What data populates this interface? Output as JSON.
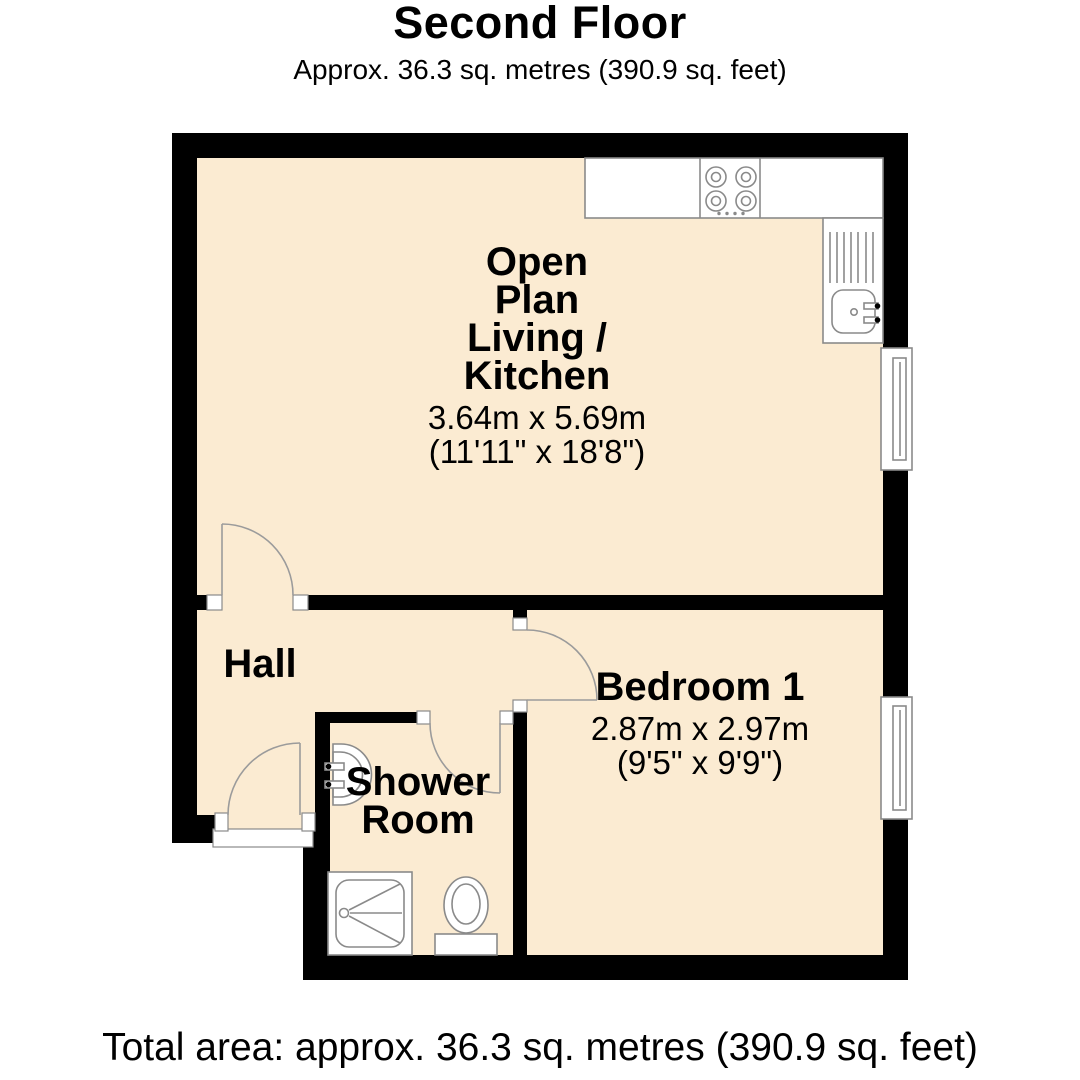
{
  "header": {
    "title": "Second Floor",
    "subtitle": "Approx. 36.3 sq. metres (390.9 sq. feet)"
  },
  "rooms": {
    "living": {
      "line1": "Open",
      "line2": "Plan",
      "line3": "Living /",
      "line4": "Kitchen",
      "dims_m": "3.64m x 5.69m",
      "dims_ft": "(11'11\" x 18'8\")"
    },
    "hall": {
      "name": "Hall"
    },
    "shower": {
      "line1": "Shower",
      "line2": "Room"
    },
    "bedroom": {
      "name": "Bedroom 1",
      "dims_m": "2.87m x 2.97m",
      "dims_ft": "(9'5\" x 9'9\")"
    }
  },
  "footer": {
    "total_area": "Total area: approx. 36.3 sq. metres (390.9 sq. feet)"
  },
  "fixtures": {
    "kitchen": [
      "worktop",
      "hob-4-ring",
      "sink-with-drainer"
    ],
    "shower_room": [
      "wash-basin",
      "shower-tray",
      "toilet"
    ],
    "windows": [
      "living-kitchen-window",
      "bedroom-window"
    ],
    "doors": [
      "living-room-door",
      "entrance-door",
      "bedroom-door",
      "shower-room-door"
    ]
  },
  "colors": {
    "floor": "#FBEBD2",
    "wall": "#000000",
    "fixture_stroke": "#8A8A8A",
    "text": "#000000",
    "background": "#FFFFFF"
  }
}
